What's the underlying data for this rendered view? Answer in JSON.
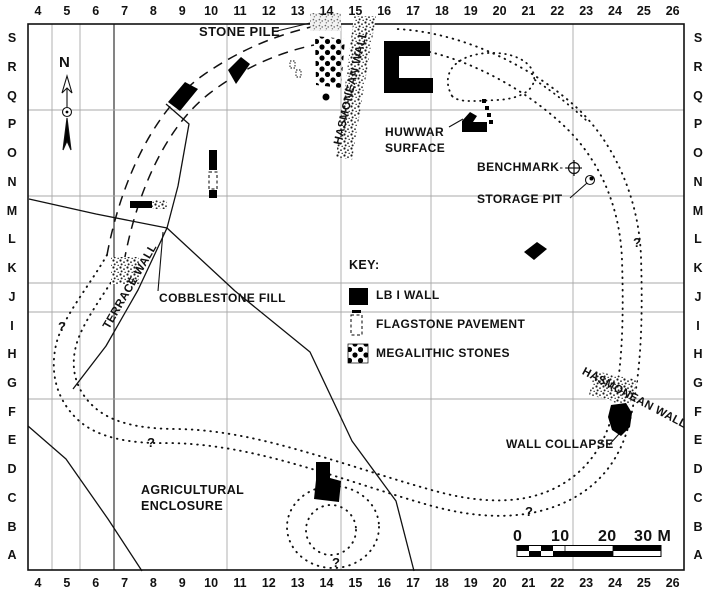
{
  "title": "Archaeological site plan",
  "grid": {
    "columns": [
      "4",
      "5",
      "6",
      "7",
      "8",
      "9",
      "10",
      "11",
      "12",
      "13",
      "14",
      "15",
      "16",
      "17",
      "18",
      "19",
      "20",
      "21",
      "22",
      "23",
      "24",
      "25",
      "26"
    ],
    "rows": [
      "S",
      "R",
      "Q",
      "P",
      "O",
      "N",
      "M",
      "L",
      "K",
      "J",
      "I",
      "H",
      "G",
      "F",
      "E",
      "D",
      "C",
      "B",
      "A"
    ]
  },
  "labels": [
    {
      "name": "north-label",
      "text": "N",
      "x": 59,
      "y": 55,
      "size": 15
    },
    {
      "name": "stone-pile-label",
      "text": "STONE PILE",
      "x": 199,
      "y": 25,
      "size": 13
    },
    {
      "name": "hasmonean-wall-nw-label",
      "text": "HASMONEAN WALL",
      "x": 352,
      "y": 88,
      "size": 11.5,
      "rotate": -77,
      "anchor": "center"
    },
    {
      "name": "huwwar-surface-label-line1",
      "text": "HUWWAR",
      "x": 385,
      "y": 126,
      "size": 12
    },
    {
      "name": "huwwar-surface-label-line2",
      "text": "SURFACE",
      "x": 385,
      "y": 142,
      "size": 12
    },
    {
      "name": "benchmark-label",
      "text": "BENCHMARK",
      "x": 477,
      "y": 161,
      "size": 12
    },
    {
      "name": "storage-pit-label",
      "text": "STORAGE PIT",
      "x": 477,
      "y": 193,
      "size": 12
    },
    {
      "name": "cobblestone-fill-label",
      "text": "COBBLESTONE FILL",
      "x": 159,
      "y": 292,
      "size": 12
    },
    {
      "name": "terrace-wall-label",
      "text": "TERRACE WALL",
      "x": 131,
      "y": 287,
      "size": 11.5,
      "rotate": -60,
      "anchor": "center"
    },
    {
      "name": "agricultural-enclosure-label-line1",
      "text": "AGRICULTURAL",
      "x": 141,
      "y": 484,
      "size": 12.5
    },
    {
      "name": "agricultural-enclosure-label-line2",
      "text": "ENCLOSURE",
      "x": 141,
      "y": 500,
      "size": 12.5
    },
    {
      "name": "wall-collapse-label",
      "text": "WALL COLLAPSE",
      "x": 506,
      "y": 438,
      "size": 12
    },
    {
      "name": "hasmonean-wall-se-label",
      "text": "HASMONEAN WALL",
      "x": 634,
      "y": 399,
      "size": 11.5,
      "rotate": 28,
      "anchor": "center"
    }
  ],
  "key": {
    "title": {
      "name": "key-title",
      "text": "KEY:",
      "x": 349,
      "y": 259,
      "size": 12.5
    },
    "items": [
      {
        "name": "key-lb1-wall-label",
        "text": "LB I WALL",
        "x": 376,
        "y": 289,
        "size": 12,
        "symbol": "solid-black-square"
      },
      {
        "name": "key-flagstone-label",
        "text": "FLAGSTONE PAVEMENT",
        "x": 376,
        "y": 318,
        "size": 12,
        "symbol": "dashed-outline-rect"
      },
      {
        "name": "key-megalithic-label",
        "text": "MEGALITHIC STONES",
        "x": 376,
        "y": 347,
        "size": 12,
        "symbol": "checkered-dots-square"
      }
    ]
  },
  "question_marks": [
    {
      "name": "question-mark-west",
      "text": "?",
      "x": 58,
      "y": 319
    },
    {
      "name": "question-mark-agricultural",
      "text": "?",
      "x": 147,
      "y": 435
    },
    {
      "name": "question-mark-bottom",
      "text": "?",
      "x": 332,
      "y": 555
    },
    {
      "name": "question-mark-south",
      "text": "?",
      "x": 525,
      "y": 504
    },
    {
      "name": "question-mark-east",
      "text": "?",
      "x": 633,
      "y": 235
    }
  ],
  "scale_bar": {
    "ticks": [
      {
        "name": "scale-tick-0",
        "text": "0",
        "x": 513,
        "y": 529
      },
      {
        "name": "scale-tick-10",
        "text": "10",
        "x": 551,
        "y": 529
      },
      {
        "name": "scale-tick-20",
        "text": "20",
        "x": 598,
        "y": 529
      },
      {
        "name": "scale-tick-30",
        "text": "30 M",
        "x": 634,
        "y": 529
      }
    ]
  },
  "colors": {
    "background": "#ffffff",
    "ink": "#000000",
    "gridline": "#a8a8a8",
    "dark_gridline": "#333333"
  }
}
